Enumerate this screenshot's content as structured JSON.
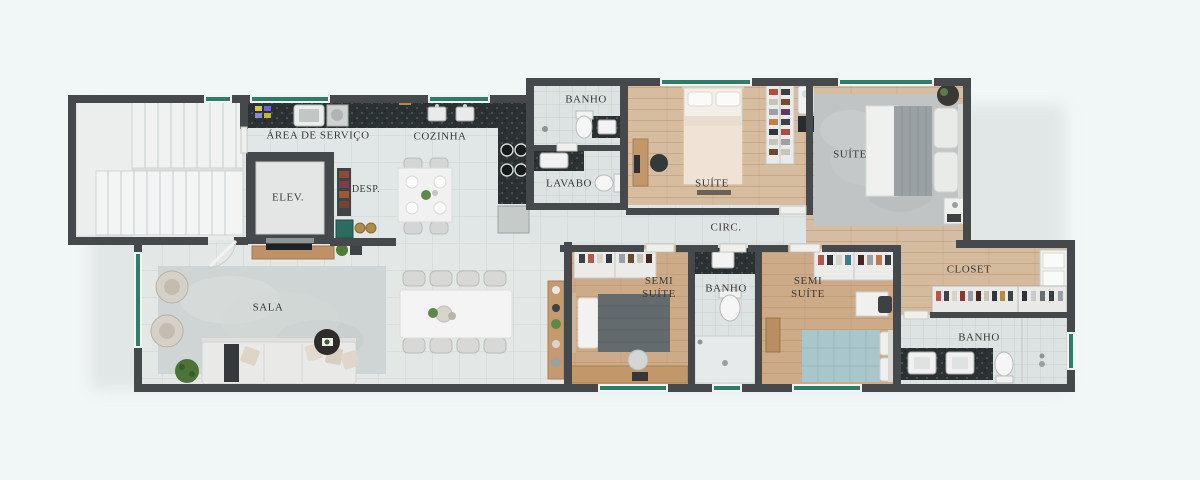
{
  "plan": {
    "type": "apartment-floor-plan",
    "rooms": {
      "area_servico": {
        "label": "ÁREA DE SERVIÇO"
      },
      "cozinha": {
        "label": "COZINHA"
      },
      "elev": {
        "label": "ELEV."
      },
      "desp": {
        "label": "DESP."
      },
      "banho_superior": {
        "label": "BANHO"
      },
      "lavabo": {
        "label": "LAVABO"
      },
      "suite_1": {
        "label": "SUÍTE"
      },
      "suite_2": {
        "label": "SUÍTE"
      },
      "circ": {
        "label": "CIRC."
      },
      "sala": {
        "label": "SALA"
      },
      "semi_suite_1": {
        "label": "SEMI SUÍTE"
      },
      "banho_central": {
        "label": "BANHO"
      },
      "semi_suite_2": {
        "label": "SEMI SUÍTE"
      },
      "closet": {
        "label": "CLOSET"
      },
      "banho_master": {
        "label": "BANHO"
      }
    },
    "palette": {
      "background": "#f1f6f6",
      "wall": "#45494b",
      "tile_floor": "#e0e6e5",
      "wood_floor": "#d5bda3",
      "bedroom_wood_floor": "#cdab88",
      "granite_counter": "#2b3133",
      "window_glass": "#2e7d6b",
      "rug": "#cfd5d4",
      "furniture_white": "#ededeb",
      "label_text": "#3a3a36"
    }
  }
}
